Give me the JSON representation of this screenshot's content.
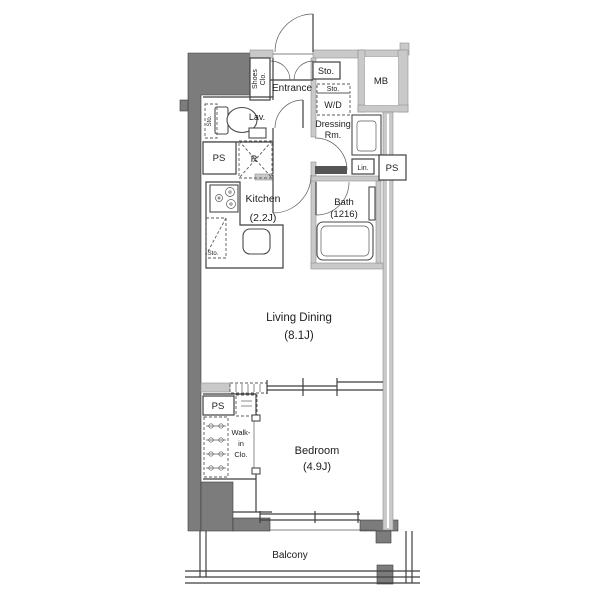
{
  "title": "Apartment floor plan",
  "colors": {
    "wall_dark": "#7c7c7c",
    "wall_light": "#c9c9c9",
    "line": "#3f3f3f",
    "background": "#ffffff"
  },
  "rooms": {
    "shoes_closet": {
      "line1": "Shoes",
      "line2": "Clo."
    },
    "entrance": {
      "label": "Entrance"
    },
    "entrance_storage": {
      "label": "Sto."
    },
    "meter_box": {
      "label": "MB"
    },
    "laundry_storage": {
      "label": "Sto."
    },
    "washer_dryer": {
      "label": "W/D"
    },
    "dressing_room": {
      "line1": "Dressing",
      "line2": "Rm."
    },
    "lavatory": {
      "label": "Lav.",
      "storage": "Sto."
    },
    "pipe_space_top": {
      "label": "PS"
    },
    "refrigerator": {
      "label": "R"
    },
    "linen": {
      "label": "Lin."
    },
    "pipe_space_right": {
      "label": "PS"
    },
    "kitchen": {
      "name": "Kitchen",
      "size": "(2.2J)",
      "storage": "Sto."
    },
    "bath": {
      "name": "Bath",
      "size": "(1216)"
    },
    "living_dining": {
      "name": "Living Dining",
      "size": "(8.1J)"
    },
    "pipe_space_bottom": {
      "label": "PS"
    },
    "walk_in_closet": {
      "line1": "Walk-",
      "line2": "in",
      "line3": "Clo."
    },
    "bedroom": {
      "name": "Bedroom",
      "size": "(4.9J)"
    },
    "balcony": {
      "label": "Balcony"
    }
  }
}
